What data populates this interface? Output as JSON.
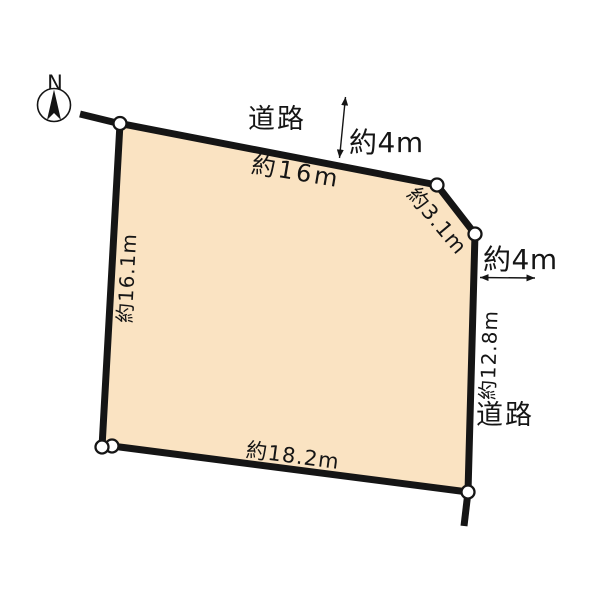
{
  "compass": {
    "north_label": "N"
  },
  "roads": {
    "top_label": "道路",
    "right_label": "道路"
  },
  "dimensions": {
    "top_road_width": "約4m",
    "right_road_width": "約4m",
    "top_edge": "約16m",
    "corner_cut_edge": "約3.1m",
    "left_edge": "約16.1m",
    "right_edge": "約12.8m",
    "bottom_edge": "約18.2m"
  },
  "colors": {
    "parcel_fill": "#FAE3C2",
    "boundary_line": "#151515",
    "marker_fill": "#FFFFFF"
  }
}
